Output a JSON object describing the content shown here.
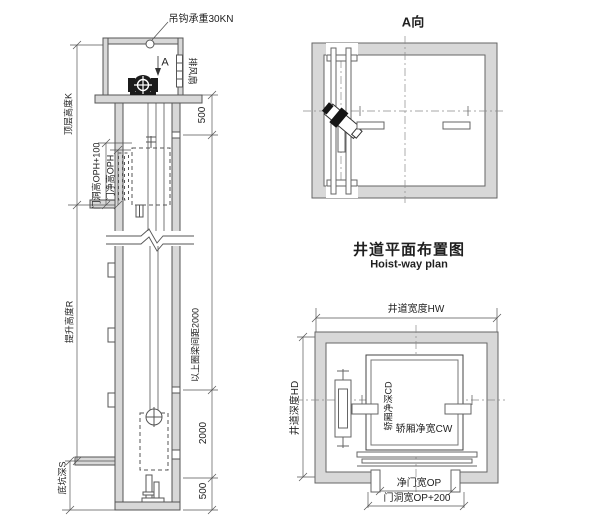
{
  "section_view": {
    "hook_load_label": "吊钩承重30KN",
    "marker_a": "A",
    "exhaust_fan_label": "排风扇",
    "dims": {
      "machine_room_500": "500",
      "top_floor_height": "顶层高度K",
      "door_opening_height": "门洞高OPH+100",
      "door_clear_height": "门净高OPH",
      "lifting_height": "提升高度R",
      "ring_beam_spacing": "以上圈梁间距2000",
      "beam_2000": "2000",
      "beam_500": "500",
      "pit_depth": "底坑深S"
    }
  },
  "a_view": {
    "title": "A向"
  },
  "hoistway_plan": {
    "title_cn": "井道平面布置图",
    "title_en": "Hoist-way plan",
    "dims": {
      "hoistway_width": "井道宽度HW",
      "hoistway_depth": "井道深度HD",
      "car_depth": "轿厢净深CD",
      "car_width": "轿厢净宽CW",
      "door_clear_width": "净门宽OP",
      "door_opening_width": "门洞宽OP+200"
    }
  },
  "colors": {
    "wall_fill": "#d8d8d8",
    "line": "#555555",
    "machine_dark": "#1b1b1b"
  }
}
